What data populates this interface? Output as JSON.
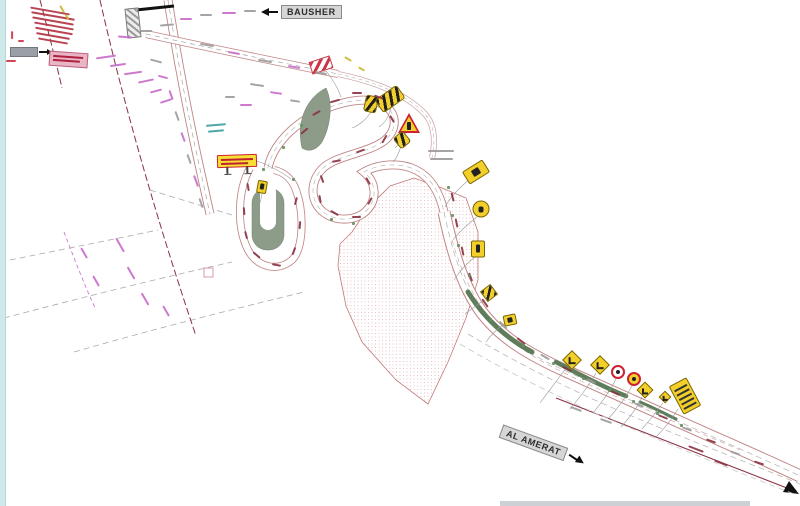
{
  "page": {
    "title": "Road works traffic diversion plan"
  },
  "labels": {
    "bausher": {
      "text": "BAUSHER",
      "arrow_direction": "left"
    },
    "al_amerat": {
      "text": "AL AMERAT",
      "arrow_direction": "right"
    }
  },
  "colors": {
    "sign_yellow": "#f2cf2a",
    "sign_border_olive": "#7a6600",
    "warning_red": "#cc2233",
    "road_edge_pink": "#c08585",
    "centerline_gray": "#a8a8a8",
    "survey_maroon": "#8a3040",
    "median_green": "#5f7d5a",
    "island_gray_green": "#8c9c88",
    "hatch_fill_pink": "#e0a0a8",
    "annotation_magenta": "#c86ac8",
    "annotation_red": "#b03040",
    "annotation_gray": "#9a9a9a",
    "annotation_teal": "#3aa0a0",
    "label_box_gray": "#d6d6d6",
    "frame_edge_blue": "#cfe8ea"
  },
  "signs": [
    {
      "name": "chevron-panel-sign",
      "type": "chevron-rect",
      "x": 371,
      "y": 104,
      "w": 13,
      "h": 17,
      "rot": 12
    },
    {
      "name": "chevron-board-sign",
      "type": "chevron-rect",
      "x": 390,
      "y": 99,
      "w": 27,
      "h": 16,
      "rot": -35
    },
    {
      "name": "sharp-curve-warning-triangle-sign",
      "type": "triangle",
      "x": 409,
      "y": 123,
      "w": 22,
      "h": 20,
      "rot": 0
    },
    {
      "name": "curve-chevron-sign",
      "type": "chevron-rect",
      "x": 402,
      "y": 140,
      "w": 13,
      "h": 14,
      "rot": -40
    },
    {
      "name": "paired-warning-sign",
      "type": "rect-glyph",
      "x": 476,
      "y": 172,
      "w": 24,
      "h": 15,
      "rot": -32
    },
    {
      "name": "roundabout-circle-sign",
      "type": "circle-yellow",
      "x": 481,
      "y": 209,
      "w": 17,
      "h": 17,
      "rot": 0
    },
    {
      "name": "road-works-sign",
      "type": "rect-glyph-portrait",
      "x": 478,
      "y": 249,
      "w": 14,
      "h": 17,
      "rot": 0
    },
    {
      "name": "alignment-chevron-diamond-sign",
      "type": "diamond-hatch",
      "x": 489,
      "y": 293,
      "w": 13,
      "h": 13,
      "rot": 8
    },
    {
      "name": "keep-left-sign",
      "type": "rect-glyph",
      "x": 510,
      "y": 320,
      "w": 13,
      "h": 11,
      "rot": -12
    },
    {
      "name": "warning-diamond-sign-1",
      "type": "diamond-glyph",
      "x": 572,
      "y": 360,
      "w": 14,
      "h": 14,
      "rot": 0
    },
    {
      "name": "warning-diamond-sign-2",
      "type": "diamond-glyph",
      "x": 600,
      "y": 365,
      "w": 14,
      "h": 14,
      "rot": 0
    },
    {
      "name": "prohibition-circle-sign",
      "type": "circle-red",
      "x": 618,
      "y": 372,
      "w": 14,
      "h": 14,
      "rot": 0
    },
    {
      "name": "speed-limit-circle-sign",
      "type": "circle-yellow-red",
      "x": 634,
      "y": 379,
      "w": 14,
      "h": 14,
      "rot": 0
    },
    {
      "name": "warning-diamond-sign-3",
      "type": "diamond-glyph",
      "x": 645,
      "y": 390,
      "w": 12,
      "h": 12,
      "rot": 0
    },
    {
      "name": "warning-diamond-sign-4",
      "type": "diamond-glyph",
      "x": 665,
      "y": 397,
      "w": 9,
      "h": 9,
      "rot": 0
    },
    {
      "name": "direction-board-sign",
      "type": "board",
      "x": 685,
      "y": 396,
      "w": 20,
      "h": 32,
      "rot": -28
    },
    {
      "name": "temporary-notice-board",
      "type": "notice",
      "x": 237,
      "y": 161,
      "w": 40,
      "h": 13,
      "rot": -2
    },
    {
      "name": "small-marker-sign",
      "type": "rect-glyph-portrait",
      "x": 262,
      "y": 187,
      "w": 10,
      "h": 13,
      "rot": 10
    },
    {
      "name": "striped-barrier-board",
      "type": "barrier",
      "x": 321,
      "y": 65,
      "w": 22,
      "h": 13,
      "rot": -18
    },
    {
      "name": "hatched-structure",
      "type": "hatch-gray",
      "x": 133,
      "y": 23,
      "w": 14,
      "h": 30,
      "rot": -6
    }
  ]
}
